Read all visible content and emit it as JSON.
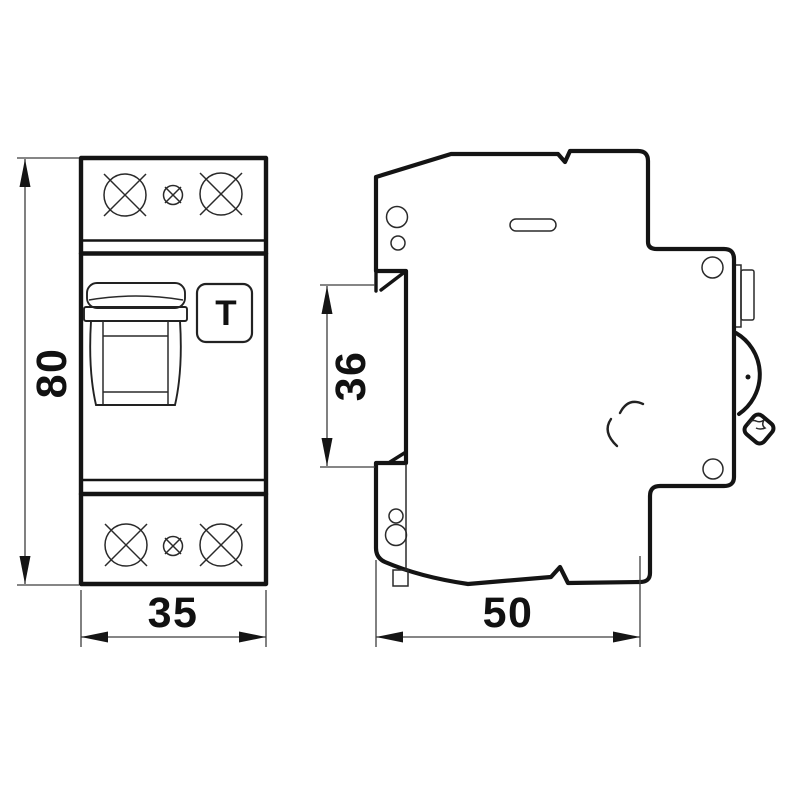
{
  "drawing": {
    "background": "#ffffff",
    "outline_color": "#141414",
    "dimension_color": "#3d3d3d",
    "labels": {
      "front_height": "80",
      "front_width": "35",
      "side_recess": "36",
      "side_depth": "50"
    },
    "test_button_label": "T"
  }
}
